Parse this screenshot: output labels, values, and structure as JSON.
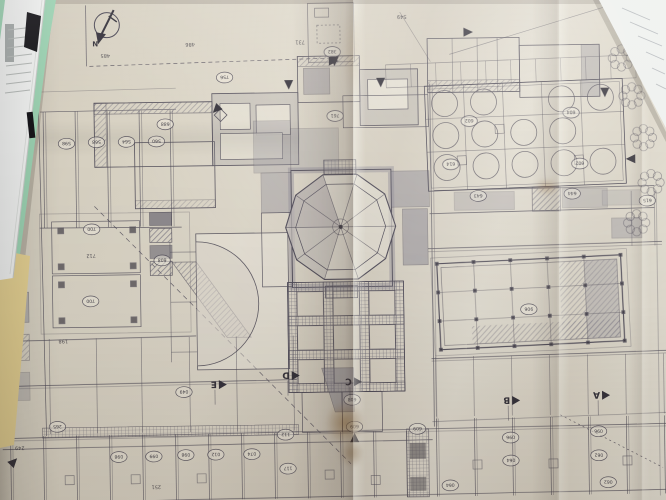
{
  "colors": {
    "paper": "#d8d1c2",
    "paper_light": "#e9e4d8",
    "line": "#4d4956",
    "wall": "#8d8a95",
    "dark": "#36333c",
    "shadow": "#b9b1a2",
    "stain": "#8a6a3e",
    "green_folder": "#9cd2b2",
    "yellow_folder": "#e4d092",
    "white_paper": "#f1f2f1",
    "adjacent_sheet": "#eef0ee",
    "clip": "#17161a"
  },
  "plan": {
    "north_label": "N",
    "survey_numbers": [
      [
        108,
        53,
        "485"
      ],
      [
        193,
        43,
        "486"
      ],
      [
        405,
        18,
        "549"
      ],
      [
        303,
        42,
        "731"
      ],
      [
        91,
        253,
        "712"
      ],
      [
        62,
        338,
        "198"
      ],
      [
        9,
        402,
        "138"
      ],
      [
        153,
        485,
        "251"
      ],
      [
        17,
        444,
        "249"
      ]
    ],
    "room_labels": [
      [
        68,
        140,
        "598"
      ],
      [
        98,
        139,
        "568"
      ],
      [
        128,
        139,
        "564"
      ],
      [
        158,
        139,
        "560"
      ],
      [
        167,
        122,
        "688"
      ],
      [
        92,
        226,
        "700"
      ],
      [
        90,
        298,
        "700"
      ],
      [
        162,
        258,
        "608"
      ],
      [
        227,
        76,
        "756"
      ],
      [
        337,
        116,
        "761"
      ],
      [
        335,
        52,
        "382"
      ],
      [
        471,
        123,
        "602"
      ],
      [
        573,
        116,
        "604"
      ],
      [
        581,
        167,
        "602"
      ],
      [
        452,
        166,
        "614"
      ],
      [
        479,
        198,
        "643"
      ],
      [
        573,
        197,
        "644"
      ],
      [
        648,
        205,
        "615"
      ],
      [
        528,
        312,
        "906"
      ],
      [
        182,
        390,
        "049"
      ],
      [
        55,
        423,
        "265"
      ],
      [
        350,
        400,
        "608"
      ],
      [
        352,
        427,
        "609"
      ],
      [
        415,
        430,
        "609"
      ],
      [
        116,
        454,
        "098"
      ],
      [
        151,
        454,
        "099"
      ],
      [
        183,
        453,
        "098"
      ],
      [
        213,
        453,
        "012"
      ],
      [
        249,
        453,
        "074"
      ],
      [
        283,
        434,
        "112"
      ],
      [
        285,
        468,
        "117"
      ],
      [
        508,
        440,
        "096"
      ],
      [
        508,
        463,
        "064"
      ],
      [
        596,
        435,
        "096"
      ],
      [
        596,
        459,
        "062"
      ],
      [
        605,
        486,
        "062"
      ],
      [
        447,
        487,
        "064"
      ]
    ],
    "section_markers": [
      {
        "x": 600,
        "y": 399,
        "label": "A"
      },
      {
        "x": 510,
        "y": 403,
        "label": "B"
      },
      {
        "x": 352,
        "y": 382,
        "label": "C"
      },
      {
        "x": 290,
        "y": 375,
        "label": "D"
      },
      {
        "x": 217,
        "y": 383,
        "label": "E"
      }
    ],
    "flow_arrows": [
      [
        219,
        107,
        -135
      ],
      [
        291,
        83,
        180
      ],
      [
        335,
        61,
        90
      ],
      [
        383,
        82,
        180
      ],
      [
        470,
        34,
        90
      ],
      [
        607,
        95,
        180
      ],
      [
        352,
        439,
        0
      ],
      [
        10,
        458,
        45
      ],
      [
        633,
        163,
        270
      ],
      [
        337,
        60,
        180
      ]
    ]
  }
}
